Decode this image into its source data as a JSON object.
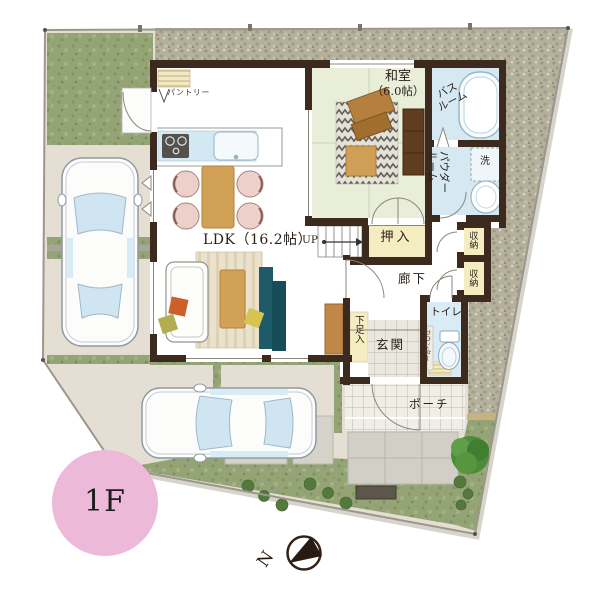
{
  "plan": {
    "labels": {
      "pantry": "パントリー",
      "ldk": "LDK（16.2帖）",
      "up": "UP",
      "washitsu1": "和室",
      "washitsu2": "（6.0帖）",
      "bath1": "バス",
      "bath2": "ルーム",
      "powder1": "パウダー",
      "powder2": "ルーム",
      "laundry": "洗",
      "oshiire": "押入",
      "hallway": "廊下",
      "storage": "収納",
      "toilet": "トイレ",
      "toilet_counter": "カウンター",
      "genkan": "玄関",
      "shoe_cabinet": "下足入",
      "porch": "ポーチ",
      "floor_badge": "1F",
      "compass_north": "N"
    },
    "colors": {
      "wall": "#3b2a1d",
      "tatami_floor": "#e9eed9",
      "wet_room_floor": "#d6e9f3",
      "closet_fill": "#f4edc2",
      "wood_furniture": "#d2a158",
      "sofa_teal": "#1e5a68",
      "grass": "#94a476",
      "gravel": "#b5b09b",
      "floor_badge_pink": "#edb9d9"
    }
  }
}
